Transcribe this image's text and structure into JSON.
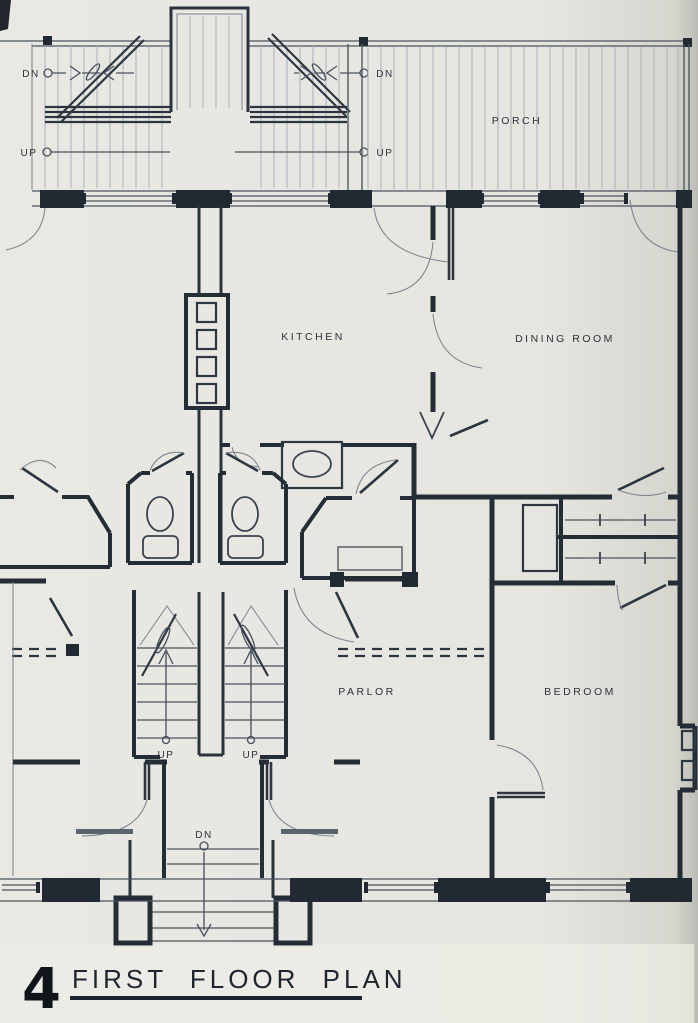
{
  "drawing": {
    "sheet_number": "4",
    "title": "FIRST FLOOR PLAN",
    "rooms": {
      "porch": "PORCH",
      "kitchen": "KITCHEN",
      "dining": "DINING ROOM",
      "parlor": "PARLOR",
      "bedroom": "BEDROOM"
    },
    "stair_labels": {
      "down": "DN",
      "up": "UP"
    },
    "colors": {
      "paper": "#e8e7e2",
      "ink": "#242d36",
      "light_line": "#7d8791"
    }
  }
}
